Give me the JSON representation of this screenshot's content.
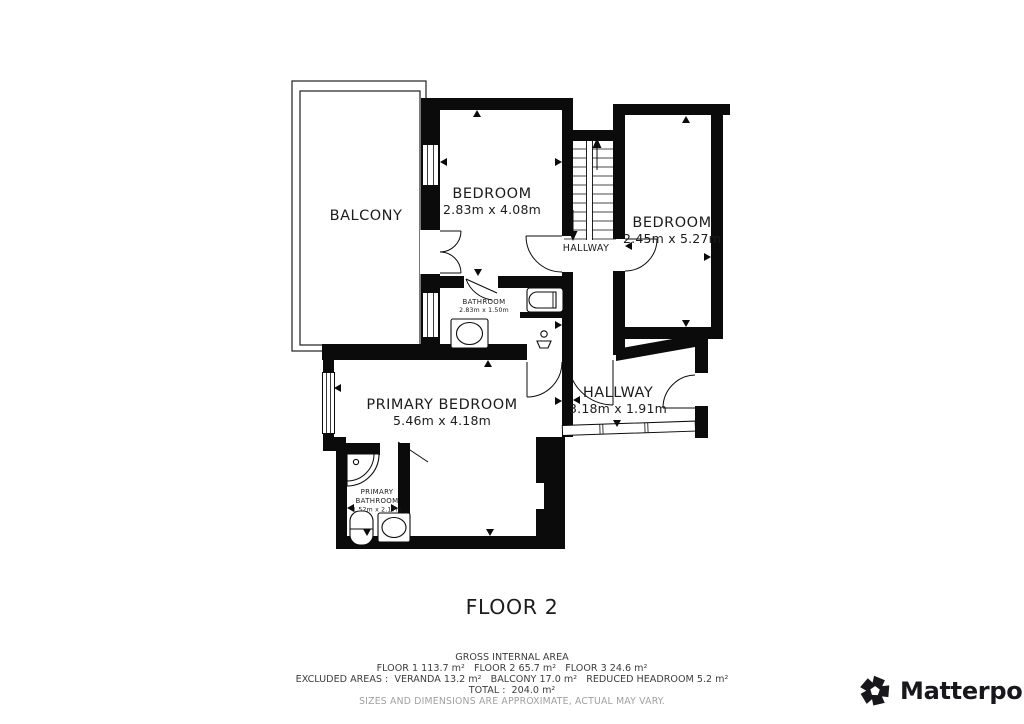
{
  "plan": {
    "balcony": {
      "name": "BALCONY"
    },
    "bedroom_top": {
      "name": "BEDROOM",
      "dims": "2.83m x 4.08m"
    },
    "bedroom_right": {
      "name": "BEDROOM",
      "dims": "2.45m x 5.27m"
    },
    "hallway_upper": {
      "name": "HALLWAY"
    },
    "bathroom": {
      "name": "BATHROOM",
      "dims": "2.83m x 1.50m"
    },
    "primary_bedroom": {
      "name": "PRIMARY BEDROOM",
      "dims": "5.46m x 4.18m"
    },
    "hallway_lower": {
      "name": "HALLWAY",
      "dims": "3.18m x 1.91m"
    },
    "primary_bathroom": {
      "name_line1": "PRIMARY",
      "name_line2": "BATHROOM",
      "dims": "1.52m x 2.17m"
    }
  },
  "floor_label": "FLOOR 2",
  "footer": {
    "title": "GROSS INTERNAL AREA",
    "line1": "FLOOR 1 113.7 m²   FLOOR 2 65.7 m²   FLOOR 3 24.6 m²",
    "line2": "EXCLUDED AREAS :  VERANDA 13.2 m²   BALCONY 17.0 m²   REDUCED HEADROOM 5.2 m²",
    "line3": "TOTAL :  204.0 m²",
    "disclaimer": "SIZES AND DIMENSIONS ARE APPROXIMATE, ACTUAL MAY VARY."
  },
  "brand": {
    "name": "Matterport",
    "mark": "®"
  },
  "colors": {
    "wall": "#0b0b0b",
    "text": "#1c1c1c",
    "muted": "#9f9f9f",
    "background": "#ffffff"
  }
}
